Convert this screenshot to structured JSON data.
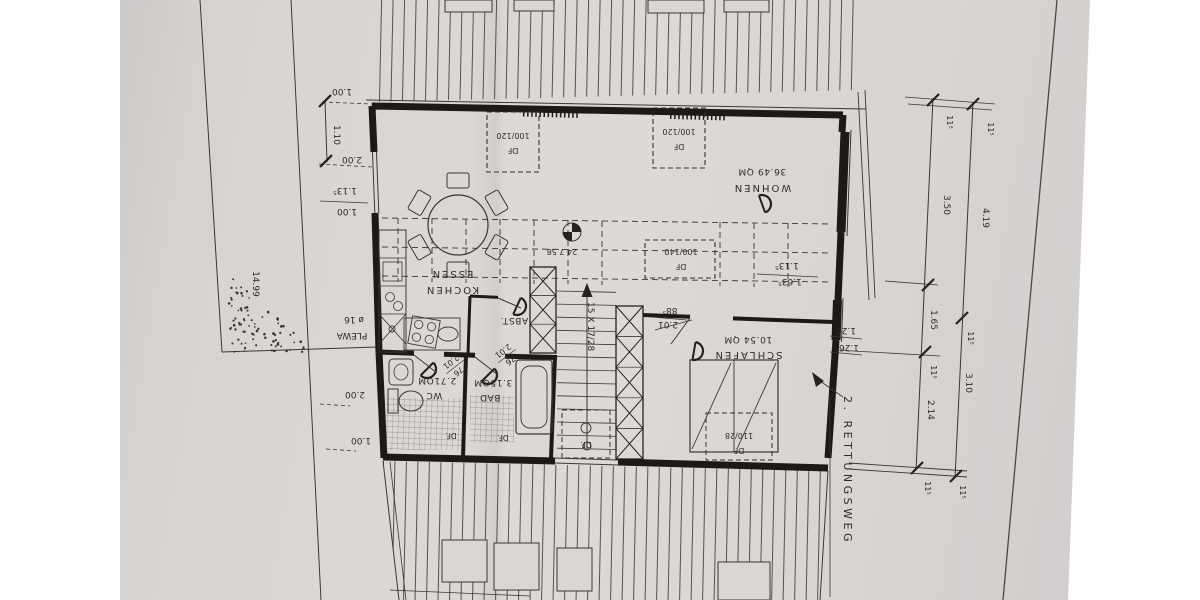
{
  "colors": {
    "paper": "#d9d6d3",
    "ink": "#3a3733",
    "wall": "#1c1916"
  },
  "rooms": {
    "wohnen": {
      "name": "WOHNEN",
      "area": "36.49 QM"
    },
    "kochen_essen": {
      "name": "KOCHEN",
      "name2": "ESSEN"
    },
    "schlafen": {
      "name": "SCHLAFEN",
      "area": "10.54 QM"
    },
    "bad": {
      "name": "BAD",
      "area": "3.15QM"
    },
    "wc": {
      "name": "WC",
      "area": "2.71QM"
    },
    "abstellraum": {
      "name": "ABST."
    }
  },
  "roof_windows": {
    "df": "DF",
    "size_a": "100/120",
    "size_b": "100/120",
    "size_c": "100/140",
    "size_d": "110/28",
    "small": "DF."
  },
  "annotations": {
    "chimney_brand": "PLEWA",
    "chimney_size": "ø 16",
    "flue_note": "24 7.58",
    "stair_note": "15 X 17/28",
    "escape_route": "2. RETTUNGSWEG"
  },
  "dimensions": {
    "left_top": "1.00",
    "left_a": "1.10",
    "left_b": "2.00",
    "left_frac_top": "1.13⁵",
    "left_frac_bottom": "1.00",
    "left_bottom_a": "2.00",
    "left_bottom_b": "1.00",
    "left_total": "14.99",
    "right_inner_a": "3.50",
    "right_inner_b": "1.65",
    "right_inner_c": "2.14",
    "right_outer_a": "4.19",
    "right_outer_b": "3.10",
    "wall": "11⁵",
    "window_a": "1.26",
    "window_b": "1.26",
    "sill_top": "1.13⁵",
    "sill_bottom": "1.63⁵",
    "door_w": "76",
    "door_h": "2.01",
    "door_schlafen_w": "88⁵",
    "door_schlafen_h": "2.01"
  }
}
